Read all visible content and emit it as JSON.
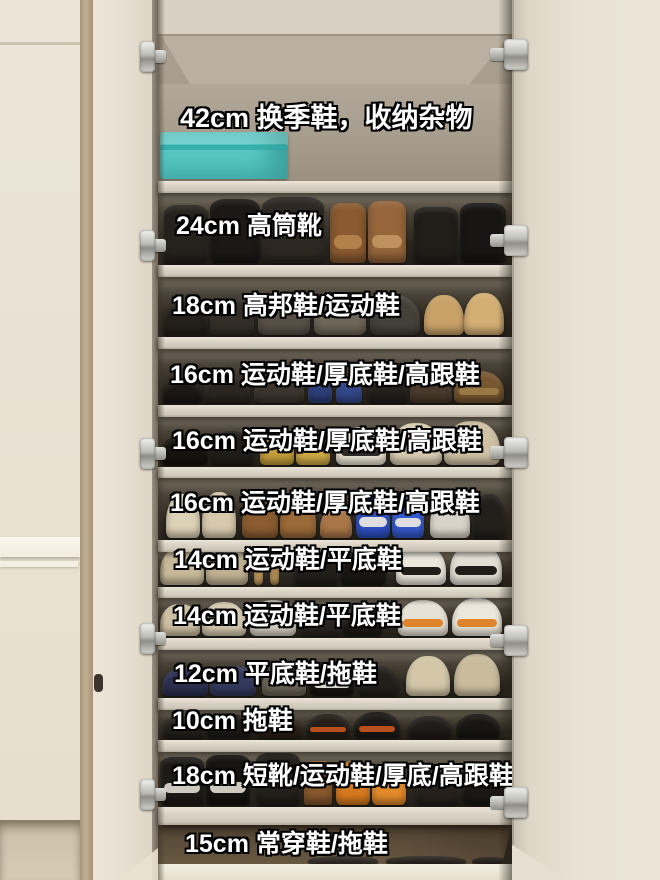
{
  "colors": {
    "wall_cream": "#e9e2d4",
    "door_cream": "#ece5d7",
    "corner_trim_tan": "#b9a78a",
    "interior_taupe": "#a79d8e",
    "shelf_board": "#dcd5c7",
    "dark_compartment": "#2b261f",
    "bottom_band_brown": "#6b5b45",
    "storage_box_teal": "#56c8c4",
    "label_text": "#ffffff",
    "label_outline": "#000000",
    "hinge_metal": "#c4c4bf"
  },
  "hinges": {
    "right_x": 490,
    "left_x": 140,
    "right_y": [
      38,
      224,
      436,
      624,
      786
    ],
    "left_y": [
      40,
      229,
      437,
      622,
      778
    ]
  },
  "cabinet": {
    "compartments": [
      {
        "height_label": "42cm",
        "use": "换季鞋，收纳杂物",
        "label": "42cm 换季鞋，收纳杂物",
        "top": 84,
        "bottom": 181,
        "board": 12,
        "label_x": 22,
        "label_y": 103,
        "large": true,
        "bg": "taupe",
        "items": [
          {
            "type": "box",
            "x": 2,
            "w": 128,
            "h": 47,
            "c": "#56c8c4",
            "c2": "#2fa9a5"
          }
        ]
      },
      {
        "height_label": "24cm",
        "use": "高筒靴",
        "label": "24cm 高筒靴",
        "top": 193,
        "bottom": 265,
        "board": 12,
        "label_x": 18,
        "label_y": 212,
        "bg": "dark",
        "items": [
          {
            "type": "boot",
            "x": 6,
            "w": 44,
            "h": 58,
            "c": "#26221e"
          },
          {
            "type": "boot",
            "x": 52,
            "w": 50,
            "h": 64,
            "c": "#1b1815"
          },
          {
            "type": "boot",
            "x": 104,
            "w": 62,
            "h": 66,
            "c": "#2e2823"
          },
          {
            "type": "boot",
            "x": 172,
            "w": 36,
            "h": 60,
            "c": "#8a5a30",
            "c2": "#b5834d"
          },
          {
            "type": "boot",
            "x": 210,
            "w": 38,
            "h": 62,
            "c": "#96653a",
            "c2": "#c09360"
          },
          {
            "type": "boot",
            "x": 256,
            "w": 44,
            "h": 56,
            "c": "#211e1a"
          },
          {
            "type": "boot",
            "x": 302,
            "w": 46,
            "h": 60,
            "c": "#181614"
          }
        ]
      },
      {
        "height_label": "18cm",
        "use": "高邦鞋/运动鞋",
        "label": "18cm 高邦鞋/运动鞋",
        "top": 277,
        "bottom": 337,
        "board": 12,
        "label_x": 14,
        "label_y": 292,
        "bg": "dark",
        "items": [
          {
            "x": 4,
            "w": 46,
            "h": 34,
            "c": "#24201b"
          },
          {
            "x": 52,
            "w": 44,
            "h": 38,
            "c": "#332e28"
          },
          {
            "x": 100,
            "w": 52,
            "h": 40,
            "c": "#575046"
          },
          {
            "x": 156,
            "w": 52,
            "h": 42,
            "c": "#6e6659"
          },
          {
            "x": 212,
            "w": 50,
            "h": 40,
            "c": "#44403a"
          },
          {
            "x": 266,
            "w": 40,
            "h": 40,
            "c": "#c9a268"
          },
          {
            "x": 306,
            "w": 40,
            "h": 42,
            "c": "#d4af74"
          }
        ]
      },
      {
        "height_label": "16cm",
        "use": "运动鞋/厚底鞋/高跟鞋",
        "label": "16cm 运动鞋/厚底鞋/高跟鞋",
        "top": 349,
        "bottom": 405,
        "board": 12,
        "label_x": 12,
        "label_y": 361,
        "bg": "dark",
        "items": [
          {
            "x": 4,
            "w": 40,
            "h": 24,
            "c": "#1b1815"
          },
          {
            "x": 46,
            "w": 46,
            "h": 28,
            "c": "#2a2520"
          },
          {
            "x": 96,
            "w": 50,
            "h": 30,
            "c": "#3b352e"
          },
          {
            "x": 150,
            "w": 24,
            "h": 26,
            "c": "#2c3e78"
          },
          {
            "x": 178,
            "w": 26,
            "h": 26,
            "c": "#33488a"
          },
          {
            "x": 210,
            "w": 40,
            "h": 28,
            "c": "#23201c"
          },
          {
            "x": 252,
            "w": 42,
            "h": 30,
            "c": "#4a3a2c"
          },
          {
            "x": 296,
            "w": 50,
            "h": 32,
            "c": "#77572f",
            "c2": "#9a7a46"
          }
        ]
      },
      {
        "height_label": "16cm",
        "use": "运动鞋/厚底鞋/高跟鞋",
        "label": "16cm 运动鞋/厚底鞋/高跟鞋",
        "top": 417,
        "bottom": 467,
        "board": 11,
        "label_x": 14,
        "label_y": 427,
        "bg": "dark",
        "items": [
          {
            "x": 2,
            "w": 48,
            "h": 30,
            "c": "#16130f"
          },
          {
            "x": 52,
            "w": 44,
            "h": 34,
            "c": "#211d18"
          },
          {
            "x": 102,
            "w": 34,
            "h": 32,
            "c": "#c59f3c"
          },
          {
            "x": 138,
            "w": 34,
            "h": 34,
            "c": "#d1ab46"
          },
          {
            "x": 178,
            "w": 50,
            "h": 38,
            "c": "#efe7d6",
            "c2": "#23201c"
          },
          {
            "x": 232,
            "w": 52,
            "h": 42,
            "c": "#d9cdb2"
          },
          {
            "x": 286,
            "w": 56,
            "h": 44,
            "c": "#cfc1a4"
          }
        ]
      },
      {
        "height_label": "16cm",
        "use": "运动鞋/厚底鞋/高跟鞋",
        "label": "16cm 运动鞋/厚底鞋/高跟鞋",
        "top": 478,
        "bottom": 540,
        "board": 12,
        "label_x": 12,
        "label_y": 489,
        "bg": "dark",
        "items": [
          {
            "x": 8,
            "w": 34,
            "h": 44,
            "c": "#ddd1b6"
          },
          {
            "x": 44,
            "w": 34,
            "h": 46,
            "c": "#d6c9ac"
          },
          {
            "x": 84,
            "w": 36,
            "h": 40,
            "c": "#8a5c30"
          },
          {
            "x": 122,
            "w": 36,
            "h": 42,
            "c": "#9a6a38"
          },
          {
            "x": 162,
            "w": 32,
            "h": 30,
            "c": "#a87647"
          },
          {
            "x": 198,
            "w": 34,
            "h": 46,
            "c": "#2d4fc0",
            "c2": "#e8e6e0"
          },
          {
            "x": 234,
            "w": 32,
            "h": 44,
            "c": "#3558cc",
            "c2": "#e8e6e0"
          },
          {
            "x": 272,
            "w": 40,
            "h": 40,
            "c": "#d8d3c8"
          },
          {
            "x": 314,
            "w": 34,
            "h": 44,
            "c": "#23201c"
          }
        ]
      },
      {
        "height_label": "14cm",
        "use": "运动鞋/平底鞋",
        "label": "14cm 运动鞋/平底鞋",
        "top": 552,
        "bottom": 587,
        "board": 11,
        "label_x": 16,
        "label_y": 546,
        "bg": "dark",
        "items": [
          {
            "x": 2,
            "w": 44,
            "h": 38,
            "c": "#c6b898"
          },
          {
            "x": 48,
            "w": 42,
            "h": 40,
            "c": "#bfb091"
          },
          {
            "type": "stick",
            "x": 96,
            "w": 9,
            "h": 26,
            "c": "#b08d55"
          },
          {
            "type": "stick",
            "x": 112,
            "w": 9,
            "h": 26,
            "c": "#a9874f"
          },
          {
            "x": 136,
            "w": 44,
            "h": 32,
            "c": "#221f1b"
          },
          {
            "x": 182,
            "w": 46,
            "h": 34,
            "c": "#191613"
          },
          {
            "x": 238,
            "w": 50,
            "h": 40,
            "c": "#eae6dc",
            "c2": "#16130f"
          },
          {
            "x": 292,
            "w": 52,
            "h": 42,
            "c": "#e3dfd4",
            "c2": "#16130f"
          }
        ]
      },
      {
        "height_label": "14cm",
        "use": "运动鞋/平底鞋",
        "label": "14cm 运动鞋/平底鞋",
        "top": 598,
        "bottom": 638,
        "board": 12,
        "label_x": 15,
        "label_y": 602,
        "bg": "dark",
        "items": [
          {
            "x": 2,
            "w": 40,
            "h": 32,
            "c": "#cdbfa2"
          },
          {
            "x": 44,
            "w": 44,
            "h": 34,
            "c": "#d6cab0"
          },
          {
            "x": 92,
            "w": 46,
            "h": 36,
            "c": "#d9d3c7"
          },
          {
            "x": 142,
            "w": 40,
            "h": 28,
            "c": "#2a2521"
          },
          {
            "x": 184,
            "w": 40,
            "h": 26,
            "c": "#1d1a16"
          },
          {
            "x": 240,
            "w": 50,
            "h": 36,
            "c": "#e6e1d5",
            "c2": "#dd8022"
          },
          {
            "x": 294,
            "w": 50,
            "h": 38,
            "c": "#ece7db",
            "c2": "#dd8022"
          }
        ]
      },
      {
        "height_label": "12cm",
        "use": "平底鞋/拖鞋",
        "label": "12cm 平底鞋/拖鞋",
        "top": 650,
        "bottom": 698,
        "board": 12,
        "label_x": 16,
        "label_y": 660,
        "bg": "dark",
        "items": [
          {
            "x": 4,
            "w": 46,
            "h": 28,
            "c": "#2c3050"
          },
          {
            "x": 52,
            "w": 46,
            "h": 30,
            "c": "#343a5e"
          },
          {
            "x": 104,
            "w": 44,
            "h": 30,
            "c": "#6b6455"
          },
          {
            "x": 152,
            "w": 44,
            "h": 32,
            "c": "#171412",
            "c2": "#e8e4da"
          },
          {
            "x": 200,
            "w": 40,
            "h": 30,
            "c": "#23201c"
          },
          {
            "x": 248,
            "w": 44,
            "h": 40,
            "c": "#d3c7a8"
          },
          {
            "x": 296,
            "w": 46,
            "h": 42,
            "c": "#c9bc9c"
          }
        ]
      },
      {
        "height_label": "10cm",
        "use": "拖鞋",
        "label": "10cm 拖鞋",
        "top": 710,
        "bottom": 740,
        "board": 12,
        "label_x": 14,
        "label_y": 707,
        "bg": "dark",
        "items": [
          {
            "x": 2,
            "w": 44,
            "h": 22,
            "c": "#26221d"
          },
          {
            "x": 48,
            "w": 46,
            "h": 24,
            "c": "#1e1b17"
          },
          {
            "x": 98,
            "w": 46,
            "h": 22,
            "c": "#2e2017"
          },
          {
            "x": 148,
            "w": 44,
            "h": 24,
            "c": "#241e18",
            "c2": "#c2521c"
          },
          {
            "x": 196,
            "w": 46,
            "h": 26,
            "c": "#1c1916",
            "c2": "#c2521c"
          },
          {
            "x": 250,
            "w": 44,
            "h": 22,
            "c": "#211d1a"
          },
          {
            "x": 298,
            "w": 44,
            "h": 24,
            "c": "#191613"
          }
        ]
      },
      {
        "height_label": "18cm",
        "use": "短靴/运动鞋/厚底/高跟鞋",
        "label": "18cm 短靴/运动鞋/厚底/高跟鞋",
        "top": 752,
        "bottom": 807,
        "board": 18,
        "label_x": 14,
        "label_y": 762,
        "bg": "dark",
        "items": [
          {
            "type": "boot",
            "x": 2,
            "w": 44,
            "h": 48,
            "c": "#1d1b18",
            "c2": "#d8d4ca"
          },
          {
            "type": "boot",
            "x": 48,
            "w": 44,
            "h": 50,
            "c": "#161411",
            "c2": "#d8d4ca"
          },
          {
            "type": "boot",
            "x": 98,
            "w": 44,
            "h": 52,
            "c": "#24201b"
          },
          {
            "type": "boot",
            "x": 146,
            "w": 28,
            "h": 44,
            "c": "#8a5a2e"
          },
          {
            "x": 178,
            "w": 34,
            "h": 44,
            "c": "#d4791f"
          },
          {
            "x": 214,
            "w": 34,
            "h": 42,
            "c": "#e08a2a"
          },
          {
            "x": 258,
            "w": 44,
            "h": 32,
            "c": "#26211c"
          },
          {
            "x": 304,
            "w": 44,
            "h": 34,
            "c": "#1b1815"
          }
        ]
      },
      {
        "height_label": "15cm",
        "use": "常穿鞋/拖鞋",
        "label": "15cm 常穿鞋/拖鞋",
        "top": 825,
        "bottom": 866,
        "board": 0,
        "label_x": 27,
        "label_y": 830,
        "bg": "floor",
        "items": [
          {
            "x": 150,
            "w": 70,
            "h": 8,
            "c": "#3b332a"
          },
          {
            "x": 228,
            "w": 80,
            "h": 8,
            "c": "#332c24"
          },
          {
            "x": 314,
            "w": 36,
            "h": 7,
            "c": "#2e2720"
          }
        ]
      }
    ]
  }
}
